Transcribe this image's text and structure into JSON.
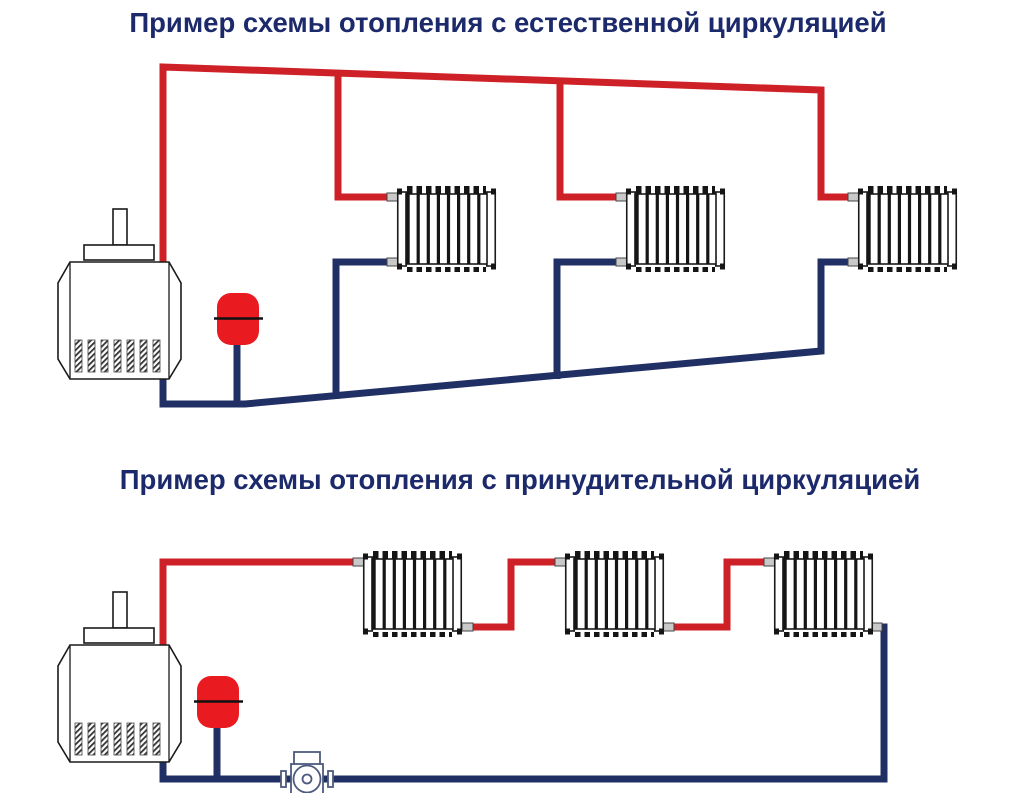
{
  "colors": {
    "background": "#ffffff",
    "title_text": "#1c2a6b",
    "supply_pipe": "#ce2127",
    "return_pipe": "#203064",
    "expansion_tank": "#e91b20",
    "equipment_outline": "#1a1a1a",
    "pump_outline": "#4e5a7d",
    "pipe_stub": "#c9c9c9"
  },
  "diagram_natural": {
    "title": "Пример схемы отопления с естественной циркуляцией",
    "components": {
      "boiler": 1,
      "expansion_tank": 1,
      "radiators": 3,
      "circulation_pump": 0
    }
  },
  "diagram_forced": {
    "title": "Пример схемы отопления с принудительной циркуляцией",
    "components": {
      "boiler": 1,
      "expansion_tank": 1,
      "radiators": 3,
      "circulation_pump": 1
    }
  }
}
